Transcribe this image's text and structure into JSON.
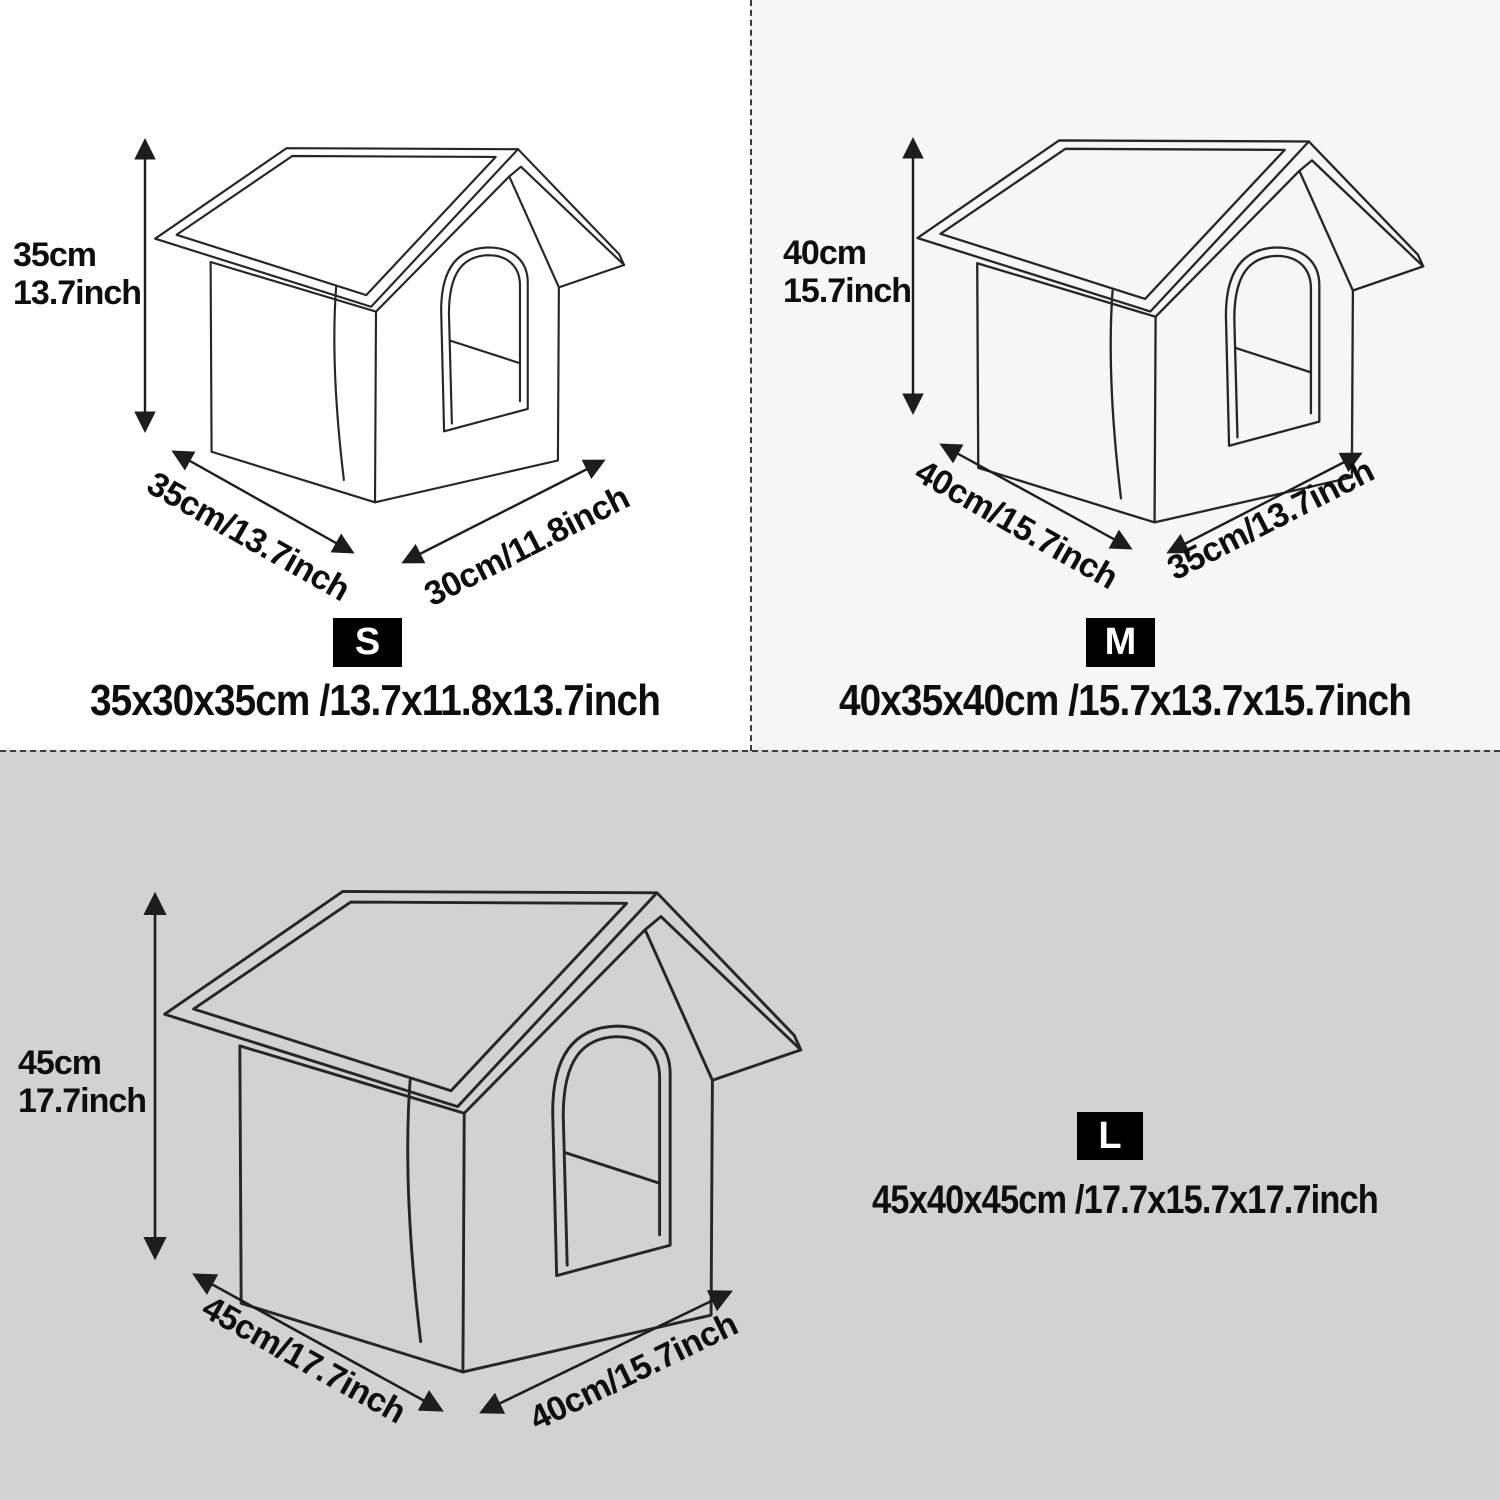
{
  "title": "Pet house size chart",
  "theme": {
    "bg_top_left": "#ffffff",
    "bg_top_right": "#f6f6f6",
    "bg_bottom": "#d2d2d2",
    "divider": "#3c3c3c",
    "line_color": "#262626",
    "badge_bg": "#000000",
    "badge_fg": "#ffffff"
  },
  "sizes": [
    {
      "badge": "S",
      "height_cm": "35cm",
      "height_inch": "13.7inch",
      "width_label": "35cm/13.7inch",
      "depth_label": "30cm/11.8inch",
      "dimensions": "35x30x35cm /13.7x11.8x13.7inch"
    },
    {
      "badge": "M",
      "height_cm": "40cm",
      "height_inch": "15.7inch",
      "width_label": "40cm/15.7inch",
      "depth_label": "35cm/13.7inch",
      "dimensions": "40x35x40cm /15.7x13.7x15.7inch"
    },
    {
      "badge": "L",
      "height_cm": "45cm",
      "height_inch": "17.7inch",
      "width_label": "45cm/17.7inch",
      "depth_label": "40cm/15.7inch",
      "dimensions": "45x40x45cm /17.7x15.7x17.7inch"
    }
  ]
}
